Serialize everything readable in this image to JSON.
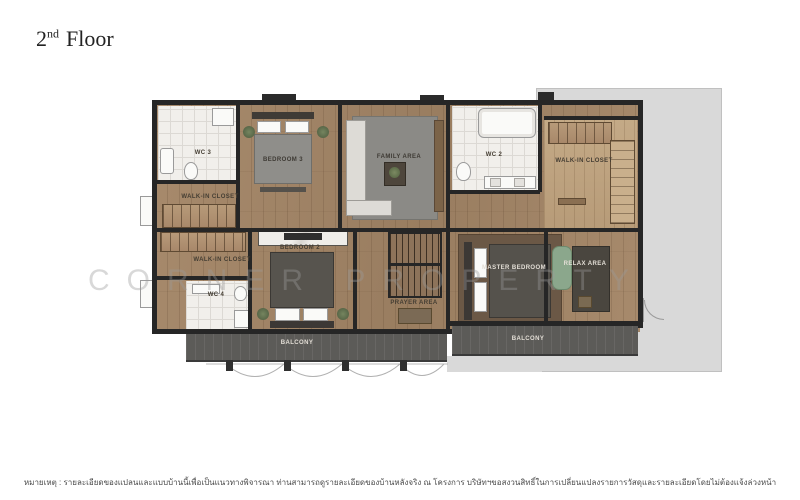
{
  "page": {
    "title": {
      "number": "2",
      "ordinal": "nd",
      "word": "Floor"
    }
  },
  "watermark": "CORNER PROPERTY",
  "plan": {
    "rooms": [
      {
        "id": "wc-3",
        "label": "WC 3"
      },
      {
        "id": "walk-in-closet-upper",
        "label": "WALK-IN CLOSET"
      },
      {
        "id": "bedroom-3",
        "label": "BEDROOM 3"
      },
      {
        "id": "family-area",
        "label": "FAMILY AREA"
      },
      {
        "id": "wc-2",
        "label": "WC 2"
      },
      {
        "id": "walk-in-closet-right",
        "label": "WALK-IN CLOSET"
      },
      {
        "id": "walk-in-closet-left",
        "label": "WALK-IN CLOSET"
      },
      {
        "id": "bedroom-2",
        "label": "BEDROOM 2"
      },
      {
        "id": "wc-4",
        "label": "WC 4"
      },
      {
        "id": "prayer-area",
        "label": "PRAYER AREA"
      },
      {
        "id": "master-bedroom",
        "label": "MASTER BEDROOM"
      },
      {
        "id": "relax-area",
        "label": "RELAX AREA"
      },
      {
        "id": "balcony-left",
        "label": "BALCONY"
      },
      {
        "id": "balcony-right",
        "label": "BALCONY"
      }
    ],
    "colors": {
      "wall": "#262626",
      "wood": "#a78a6c",
      "wood_light": "#c4aa87",
      "tile": "#f1efeb",
      "deck": "#5c5b58",
      "terrace": "#d9d9d9",
      "rug": "#8b8a86",
      "green_chair": "#8ba78c"
    }
  },
  "footer": {
    "note": "หมายเหตุ : รายละเอียดของแปลนและแบบบ้านนี้เพื่อเป็นแนวทางพิจารณา ท่านสามารถดูรายละเอียดของบ้านหลังจริง ณ โครงการ บริษัทฯขอสงวนสิทธิ์ในการเปลี่ยนแปลงรายการวัสดุและรายละเอียดโดยไม่ต้องแจ้งล่วงหน้า"
  }
}
